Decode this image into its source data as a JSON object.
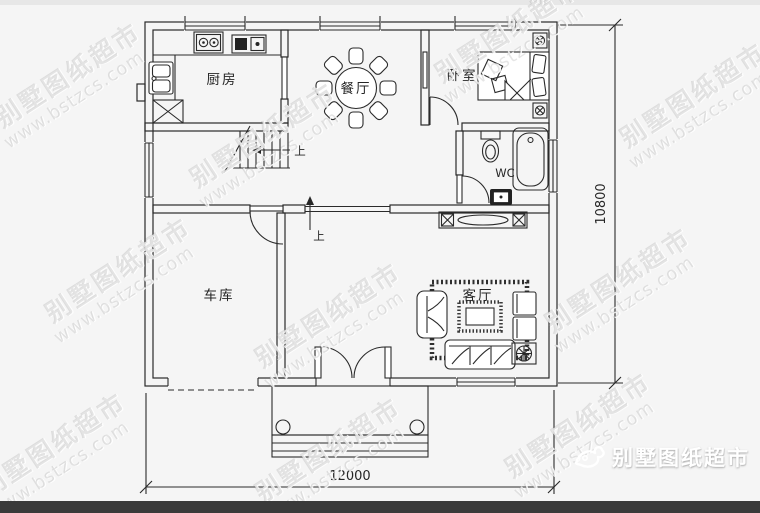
{
  "watermark": {
    "line1": "别墅图纸超市",
    "line2": "www.bstzcs.com"
  },
  "rooms": {
    "kitchen": "厨房",
    "dining": "餐厅",
    "bedroom": "卧室",
    "wc": "WC",
    "garage": "车库",
    "living": "客厅"
  },
  "stairs": {
    "up1": "上",
    "up2": "上"
  },
  "dimensions": {
    "bottom": "12000",
    "right": "10800"
  },
  "footer": {
    "brand": "别墅图纸超市"
  },
  "colors": {
    "line": "#2a2a2a",
    "background": "#f5f5f5",
    "footer_bar": "#3a3a3a",
    "watermark": "#c9c9c9",
    "logo_text": "#ffffff"
  }
}
